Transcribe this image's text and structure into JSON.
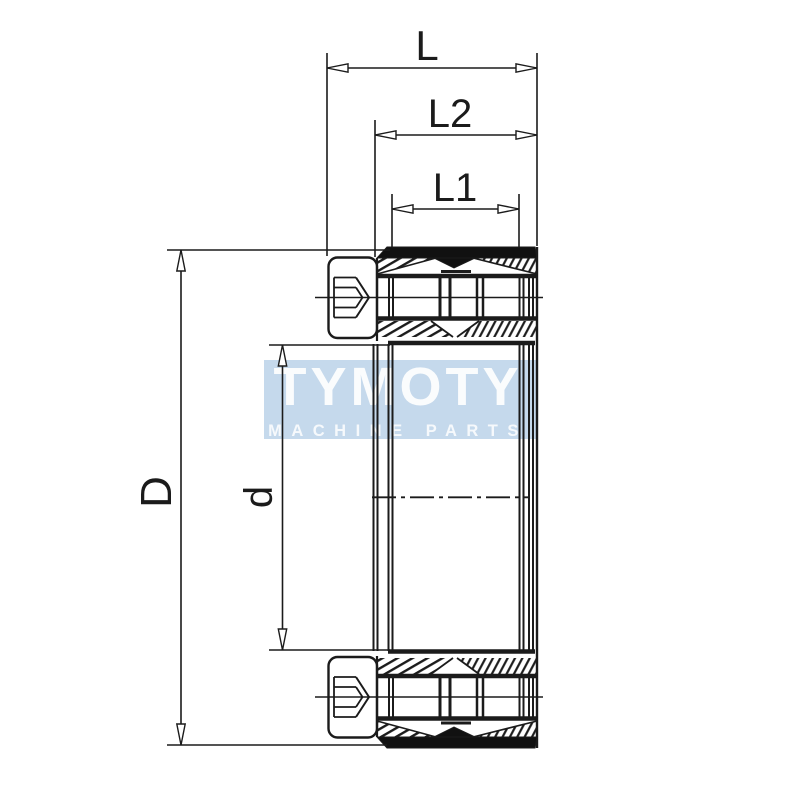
{
  "drawing": {
    "type": "technical-section-drawing",
    "subject": "cone clamping element cross-section with socket head cap screws",
    "dimensions": {
      "overall_length": {
        "label": "L"
      },
      "outer_ring_length": {
        "label": "L2"
      },
      "inner_ring_length": {
        "label": "L1"
      },
      "outer_diameter": {
        "label": "D"
      },
      "bore_diameter": {
        "label": "d"
      }
    },
    "watermark": {
      "brand": "TYMOTY",
      "tagline": "MACHINE PARTS"
    },
    "colors": {
      "background": "#ffffff",
      "line": "#1b1b1b",
      "watermark_band": "#c5d9ec",
      "watermark_text": "#ffffff"
    }
  }
}
